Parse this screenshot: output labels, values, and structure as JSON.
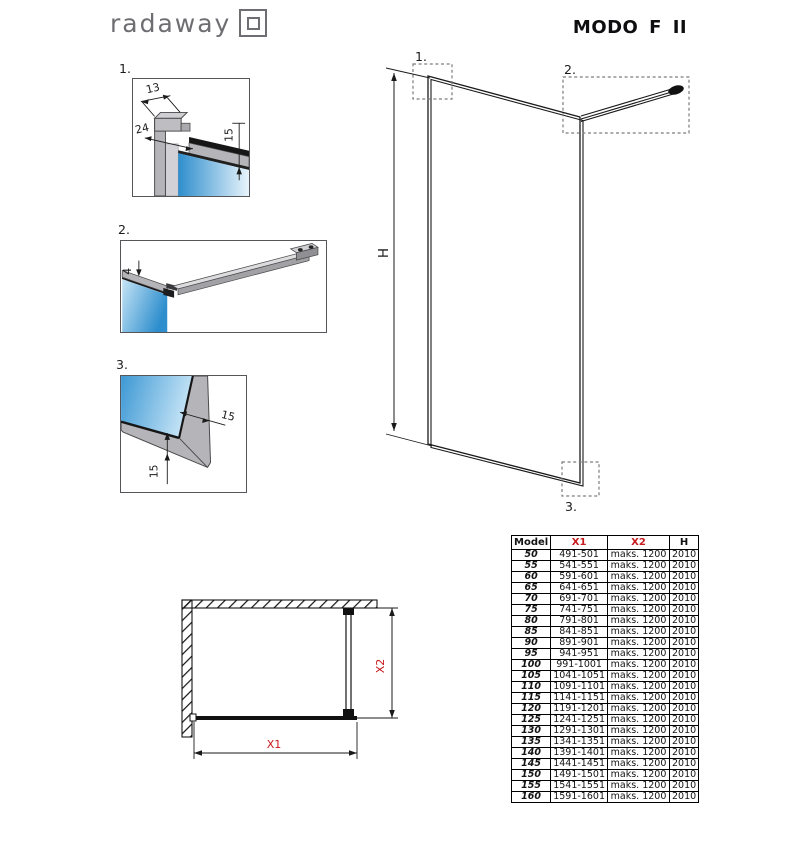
{
  "header": {
    "logo_text": "radaway",
    "title": "MODO F II"
  },
  "details": [
    {
      "label": "1.",
      "dim_top_width": "13",
      "dim_profile_depth": "24",
      "dim_glass_inset": "15"
    },
    {
      "label": "2.",
      "dim_arm_offset": "4"
    },
    {
      "label": "3.",
      "dim_side_inset": "15",
      "dim_bottom_inset": "15"
    }
  ],
  "elevation": {
    "marker_1": "1.",
    "marker_2": "2.",
    "marker_3": "3.",
    "height_label": "H"
  },
  "plan": {
    "width_label": "X1",
    "depth_label": "X2"
  },
  "table": {
    "headers": [
      "Model",
      "X1",
      "X2",
      "H"
    ],
    "rows": [
      [
        "50",
        "491-501",
        "maks. 1200",
        "2010"
      ],
      [
        "55",
        "541-551",
        "maks. 1200",
        "2010"
      ],
      [
        "60",
        "591-601",
        "maks. 1200",
        "2010"
      ],
      [
        "65",
        "641-651",
        "maks. 1200",
        "2010"
      ],
      [
        "70",
        "691-701",
        "maks. 1200",
        "2010"
      ],
      [
        "75",
        "741-751",
        "maks. 1200",
        "2010"
      ],
      [
        "80",
        "791-801",
        "maks. 1200",
        "2010"
      ],
      [
        "85",
        "841-851",
        "maks. 1200",
        "2010"
      ],
      [
        "90",
        "891-901",
        "maks. 1200",
        "2010"
      ],
      [
        "95",
        "941-951",
        "maks. 1200",
        "2010"
      ],
      [
        "100",
        "991-1001",
        "maks. 1200",
        "2010"
      ],
      [
        "105",
        "1041-1051",
        "maks. 1200",
        "2010"
      ],
      [
        "110",
        "1091-1101",
        "maks. 1200",
        "2010"
      ],
      [
        "115",
        "1141-1151",
        "maks. 1200",
        "2010"
      ],
      [
        "120",
        "1191-1201",
        "maks. 1200",
        "2010"
      ],
      [
        "125",
        "1241-1251",
        "maks. 1200",
        "2010"
      ],
      [
        "130",
        "1291-1301",
        "maks. 1200",
        "2010"
      ],
      [
        "135",
        "1341-1351",
        "maks. 1200",
        "2010"
      ],
      [
        "140",
        "1391-1401",
        "maks. 1200",
        "2010"
      ],
      [
        "145",
        "1441-1451",
        "maks. 1200",
        "2010"
      ],
      [
        "150",
        "1491-1501",
        "maks. 1200",
        "2010"
      ],
      [
        "155",
        "1541-1551",
        "maks. 1200",
        "2010"
      ],
      [
        "160",
        "1591-1601",
        "maks. 1200",
        "2010"
      ]
    ]
  },
  "colors": {
    "accent_red": "#c8191c",
    "glass_blue": "#2e8ecd",
    "glass_light": "#e4f1fa",
    "frame_gray": "#b6b6ba"
  }
}
